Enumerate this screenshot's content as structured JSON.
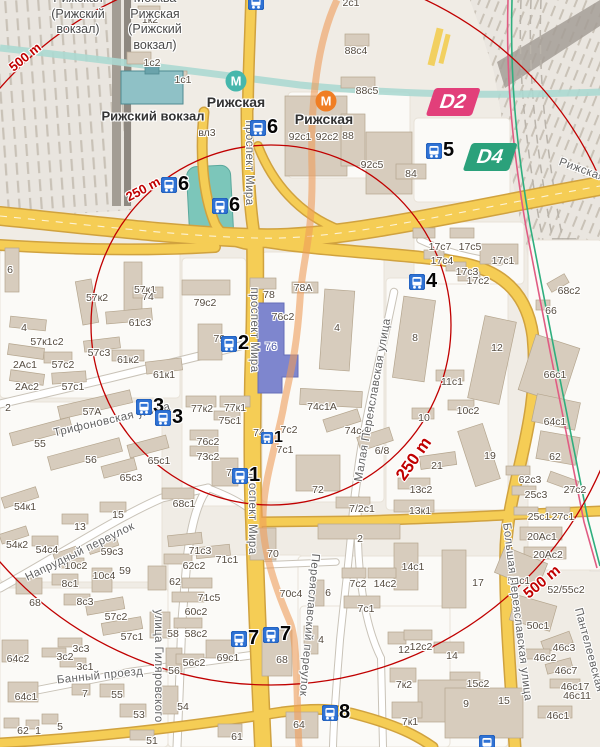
{
  "map": {
    "colors": {
      "land": "#f0ece5",
      "quarter": "#fbfaf7",
      "road_major": "#f5cd55",
      "road_major_casing": "#d0a23f",
      "building": "#d7ccbd",
      "building_stroke": "#b5a68f",
      "water": "#7cc6ba",
      "river": "#acd9d2",
      "rail_area": "#e9e5df",
      "radius_circle": "#c00000",
      "metro_line_overlay": "#ee9d5a",
      "rail_line_green": "#2fae7e",
      "rail_line_pink": "#e05c83",
      "marker_blue": "#2f72d4",
      "highlight_building": "#7e86ce",
      "station_building": "#8fc1c6"
    },
    "circles": {
      "cx": 271,
      "cy": 325,
      "r250": 180,
      "r500": 360
    },
    "radius_labels": [
      {
        "t": "500 m",
        "x": 25,
        "y": 57,
        "r": -39,
        "s": 13
      },
      {
        "t": "250 m",
        "x": 143,
        "y": 189,
        "r": -28,
        "s": 13
      },
      {
        "t": "250 m",
        "x": 414,
        "y": 459,
        "r": -55,
        "s": 17
      },
      {
        "t": "500 m",
        "x": 542,
        "y": 582,
        "r": -40,
        "s": 15
      }
    ],
    "poi_labels": [
      {
        "t": "Рижский вокзал",
        "x": 153,
        "y": 116,
        "s": 13
      },
      {
        "t": "Рижская",
        "x": 236,
        "y": 102,
        "s": 14
      },
      {
        "t": "Рижская",
        "x": 324,
        "y": 119,
        "s": 14
      }
    ],
    "platform_labels": [
      {
        "x": 78,
        "y": -9,
        "lines": [
          "Рижская",
          "(Рижский",
          "вокзал)"
        ]
      },
      {
        "x": 155,
        "y": -9,
        "lines": [
          "Москва",
          "Рижская",
          "(Рижский",
          "вокзал)"
        ]
      }
    ],
    "street_labels": [
      {
        "t": "проспект Мира",
        "x": 249,
        "y": 163,
        "r": 90
      },
      {
        "t": "проспект Мира",
        "x": 254,
        "y": 330,
        "r": 90
      },
      {
        "t": "проспект Мира",
        "x": 252,
        "y": 512,
        "r": 90
      },
      {
        "t": "Трифоновская улица",
        "x": 112,
        "y": 420,
        "r": -13
      },
      {
        "t": "Напрудный переулок",
        "x": 80,
        "y": 552,
        "r": -26
      },
      {
        "t": "Банный проезд",
        "x": 100,
        "y": 676,
        "r": -6
      },
      {
        "t": "улица Гиляровского",
        "x": 158,
        "y": 666,
        "r": 90
      },
      {
        "t": "Малая Переяславская улица",
        "x": 373,
        "y": 400,
        "r": -80
      },
      {
        "t": "Большая Переяславская улица",
        "x": 517,
        "y": 612,
        "r": 83
      },
      {
        "t": "Переяславский переулок",
        "x": 309,
        "y": 625,
        "r": 95
      },
      {
        "t": "Пантелеевская",
        "x": 589,
        "y": 650,
        "r": 75
      },
      {
        "t": "Рижская",
        "x": 582,
        "y": 170,
        "r": 20
      }
    ],
    "building_labels": [
      {
        "t": "1к2",
        "x": 150,
        "y": 20
      },
      {
        "t": "1с2",
        "x": 152,
        "y": 63
      },
      {
        "t": "1с1",
        "x": 183,
        "y": 80
      },
      {
        "t": "вл3",
        "x": 207,
        "y": 133
      },
      {
        "t": "92с1",
        "x": 300,
        "y": 137
      },
      {
        "t": "92с2",
        "x": 327,
        "y": 137
      },
      {
        "t": "88",
        "x": 348,
        "y": 136
      },
      {
        "t": "88с4",
        "x": 356,
        "y": 51
      },
      {
        "t": "88с5",
        "x": 367,
        "y": 91
      },
      {
        "t": "92с5",
        "x": 372,
        "y": 165
      },
      {
        "t": "84",
        "x": 411,
        "y": 174
      },
      {
        "t": "2с1",
        "x": 351,
        "y": 3
      },
      {
        "t": "6",
        "x": 10,
        "y": 270
      },
      {
        "t": "57к1",
        "x": 145,
        "y": 290
      },
      {
        "t": "57к2",
        "x": 97,
        "y": 298
      },
      {
        "t": "74",
        "x": 148,
        "y": 297
      },
      {
        "t": "79с2",
        "x": 205,
        "y": 303
      },
      {
        "t": "78",
        "x": 269,
        "y": 295
      },
      {
        "t": "78А",
        "x": 303,
        "y": 288
      },
      {
        "t": "76с2",
        "x": 283,
        "y": 317
      },
      {
        "t": "61с3",
        "x": 140,
        "y": 323
      },
      {
        "t": "4",
        "x": 24,
        "y": 328
      },
      {
        "t": "57к1с2",
        "x": 47,
        "y": 342
      },
      {
        "t": "57с3",
        "x": 99,
        "y": 353
      },
      {
        "t": "61к2",
        "x": 128,
        "y": 360
      },
      {
        "t": "2Ас1",
        "x": 25,
        "y": 365
      },
      {
        "t": "57с2",
        "x": 63,
        "y": 365
      },
      {
        "t": "61к1",
        "x": 164,
        "y": 375
      },
      {
        "t": "2Ас2",
        "x": 27,
        "y": 387
      },
      {
        "t": "57с1",
        "x": 73,
        "y": 387
      },
      {
        "t": "57А",
        "x": 92,
        "y": 412
      },
      {
        "t": "2",
        "x": 8,
        "y": 408
      },
      {
        "t": "79с",
        "x": 222,
        "y": 339
      },
      {
        "t": "76",
        "x": 271,
        "y": 347,
        "c": "#4d58a9",
        "s": 11
      },
      {
        "t": "77к2",
        "x": 202,
        "y": 409
      },
      {
        "t": "77к1",
        "x": 235,
        "y": 408
      },
      {
        "t": "75с1",
        "x": 230,
        "y": 421
      },
      {
        "t": "76с2",
        "x": 208,
        "y": 442
      },
      {
        "t": "73с2",
        "x": 208,
        "y": 457
      },
      {
        "t": "73",
        "x": 232,
        "y": 473
      },
      {
        "t": "74",
        "x": 259,
        "y": 433
      },
      {
        "t": "7с2",
        "x": 289,
        "y": 430
      },
      {
        "t": "7с1",
        "x": 285,
        "y": 450
      },
      {
        "t": "74с1А",
        "x": 322,
        "y": 407
      },
      {
        "t": "74с4",
        "x": 356,
        "y": 431
      },
      {
        "t": "6/8",
        "x": 382,
        "y": 451
      },
      {
        "t": "72",
        "x": 318,
        "y": 490
      },
      {
        "t": "7/2с1",
        "x": 362,
        "y": 509
      },
      {
        "t": "17с7",
        "x": 440,
        "y": 247
      },
      {
        "t": "17с5",
        "x": 470,
        "y": 247
      },
      {
        "t": "17с4",
        "x": 442,
        "y": 261
      },
      {
        "t": "17с1",
        "x": 503,
        "y": 261
      },
      {
        "t": "17с3",
        "x": 467,
        "y": 272
      },
      {
        "t": "17с2",
        "x": 478,
        "y": 281
      },
      {
        "t": "68с2",
        "x": 569,
        "y": 291
      },
      {
        "t": "66",
        "x": 551,
        "y": 311
      },
      {
        "t": "4",
        "x": 337,
        "y": 328
      },
      {
        "t": "8",
        "x": 415,
        "y": 338
      },
      {
        "t": "12",
        "x": 497,
        "y": 348
      },
      {
        "t": "66с1",
        "x": 555,
        "y": 375
      },
      {
        "t": "11с1",
        "x": 452,
        "y": 382
      },
      {
        "t": "10с2",
        "x": 468,
        "y": 411
      },
      {
        "t": "10",
        "x": 424,
        "y": 418
      },
      {
        "t": "64с1",
        "x": 555,
        "y": 422
      },
      {
        "t": "19",
        "x": 490,
        "y": 456
      },
      {
        "t": "62",
        "x": 555,
        "y": 457
      },
      {
        "t": "21",
        "x": 437,
        "y": 466
      },
      {
        "t": "13с2",
        "x": 421,
        "y": 490
      },
      {
        "t": "62с3",
        "x": 530,
        "y": 480
      },
      {
        "t": "25с3",
        "x": 536,
        "y": 495
      },
      {
        "t": "27с2",
        "x": 575,
        "y": 490
      },
      {
        "t": "13к1",
        "x": 420,
        "y": 511
      },
      {
        "t": "25с1",
        "x": 539,
        "y": 517
      },
      {
        "t": "27с1",
        "x": 563,
        "y": 517
      },
      {
        "t": "2",
        "x": 360,
        "y": 539
      },
      {
        "t": "20Ас1",
        "x": 542,
        "y": 537
      },
      {
        "t": "20Ас2",
        "x": 548,
        "y": 555
      },
      {
        "t": "14с1",
        "x": 413,
        "y": 567
      },
      {
        "t": "55",
        "x": 40,
        "y": 444
      },
      {
        "t": "56",
        "x": 91,
        "y": 460
      },
      {
        "t": "65с1",
        "x": 159,
        "y": 461
      },
      {
        "t": "65с3",
        "x": 131,
        "y": 478
      },
      {
        "t": "68с1",
        "x": 184,
        "y": 504
      },
      {
        "t": "15",
        "x": 118,
        "y": 515
      },
      {
        "t": "13",
        "x": 80,
        "y": 527
      },
      {
        "t": "54к1",
        "x": 25,
        "y": 507
      },
      {
        "t": "54к2",
        "x": 17,
        "y": 545
      },
      {
        "t": "54с4",
        "x": 47,
        "y": 550
      },
      {
        "t": "59с3",
        "x": 112,
        "y": 552
      },
      {
        "t": "10с2",
        "x": 76,
        "y": 566
      },
      {
        "t": "10с4",
        "x": 104,
        "y": 576
      },
      {
        "t": "59",
        "x": 125,
        "y": 571
      },
      {
        "t": "70",
        "x": 273,
        "y": 554
      },
      {
        "t": "71с3",
        "x": 200,
        "y": 551
      },
      {
        "t": "71с1",
        "x": 227,
        "y": 560
      },
      {
        "t": "62с2",
        "x": 194,
        "y": 566
      },
      {
        "t": "62",
        "x": 175,
        "y": 582
      },
      {
        "t": "71с5",
        "x": 209,
        "y": 598
      },
      {
        "t": "60с2",
        "x": 196,
        "y": 612
      },
      {
        "t": "70с4",
        "x": 291,
        "y": 594
      },
      {
        "t": "58",
        "x": 173,
        "y": 634
      },
      {
        "t": "58с2",
        "x": 196,
        "y": 634
      },
      {
        "t": "56с2",
        "x": 194,
        "y": 663
      },
      {
        "t": "56",
        "x": 174,
        "y": 671
      },
      {
        "t": "69с1",
        "x": 228,
        "y": 658
      },
      {
        "t": "68",
        "x": 282,
        "y": 660
      },
      {
        "t": "54",
        "x": 183,
        "y": 707
      },
      {
        "t": "61",
        "x": 237,
        "y": 737
      },
      {
        "t": "68",
        "x": 35,
        "y": 603
      },
      {
        "t": "8с1",
        "x": 70,
        "y": 584
      },
      {
        "t": "8с3",
        "x": 85,
        "y": 602
      },
      {
        "t": "57с2",
        "x": 116,
        "y": 617
      },
      {
        "t": "57с1",
        "x": 132,
        "y": 637
      },
      {
        "t": "3с3",
        "x": 81,
        "y": 649
      },
      {
        "t": "3с2",
        "x": 65,
        "y": 657
      },
      {
        "t": "3с1",
        "x": 85,
        "y": 667
      },
      {
        "t": "64с2",
        "x": 18,
        "y": 659
      },
      {
        "t": "64с1",
        "x": 26,
        "y": 697
      },
      {
        "t": "7",
        "x": 85,
        "y": 694
      },
      {
        "t": "55",
        "x": 117,
        "y": 695
      },
      {
        "t": "53",
        "x": 139,
        "y": 715
      },
      {
        "t": "5",
        "x": 60,
        "y": 727
      },
      {
        "t": "1",
        "x": 38,
        "y": 731
      },
      {
        "t": "62",
        "x": 23,
        "y": 731
      },
      {
        "t": "51",
        "x": 152,
        "y": 741
      },
      {
        "t": "64",
        "x": 299,
        "y": 725
      },
      {
        "t": "7с2",
        "x": 358,
        "y": 584
      },
      {
        "t": "14с2",
        "x": 385,
        "y": 584
      },
      {
        "t": "7с1",
        "x": 366,
        "y": 609
      },
      {
        "t": "6",
        "x": 328,
        "y": 593
      },
      {
        "t": "4",
        "x": 321,
        "y": 640
      },
      {
        "t": "17",
        "x": 478,
        "y": 583
      },
      {
        "t": "52с1",
        "x": 519,
        "y": 581
      },
      {
        "t": "52/55с2",
        "x": 566,
        "y": 590
      },
      {
        "t": "50с1",
        "x": 538,
        "y": 626
      },
      {
        "t": "46с3",
        "x": 564,
        "y": 648
      },
      {
        "t": "46с2",
        "x": 545,
        "y": 658
      },
      {
        "t": "46с7",
        "x": 566,
        "y": 671
      },
      {
        "t": "46с17",
        "x": 575,
        "y": 687
      },
      {
        "t": "46с11",
        "x": 577,
        "y": 696
      },
      {
        "t": "46с1",
        "x": 558,
        "y": 716
      },
      {
        "t": "12",
        "x": 404,
        "y": 650
      },
      {
        "t": "12с2",
        "x": 421,
        "y": 647
      },
      {
        "t": "14",
        "x": 452,
        "y": 656
      },
      {
        "t": "15с2",
        "x": 478,
        "y": 684
      },
      {
        "t": "15",
        "x": 504,
        "y": 701
      },
      {
        "t": "9",
        "x": 466,
        "y": 704
      },
      {
        "t": "7к2",
        "x": 404,
        "y": 685
      },
      {
        "t": "7к1",
        "x": 410,
        "y": 722
      }
    ],
    "markers": [
      {
        "n": "6",
        "x": 258,
        "y": 124
      },
      {
        "n": "6",
        "x": 169,
        "y": 181
      },
      {
        "n": "6",
        "x": 220,
        "y": 202
      },
      {
        "n": "5",
        "x": 434,
        "y": 147,
        "icon": "train"
      },
      {
        "n": "4",
        "x": 417,
        "y": 278
      },
      {
        "n": "2",
        "x": 229,
        "y": 340
      },
      {
        "n": "3",
        "x": 144,
        "y": 403
      },
      {
        "n": "3",
        "x": 163,
        "y": 414
      },
      {
        "n": "1",
        "x": 267,
        "y": 435,
        "small": true
      },
      {
        "n": "1",
        "x": 240,
        "y": 472
      },
      {
        "n": "7",
        "x": 239,
        "y": 635
      },
      {
        "n": "7",
        "x": 271,
        "y": 631
      },
      {
        "n": "8",
        "x": 330,
        "y": 709
      },
      {
        "n": "",
        "x": 487,
        "y": 743
      },
      {
        "n": "",
        "x": 256,
        "y": 2
      }
    ],
    "metro_logos": [
      {
        "t": "М",
        "x": 236,
        "y": 81,
        "c": "#46b7ac"
      },
      {
        "t": "М",
        "x": 326,
        "y": 101,
        "c": "#f07e24"
      }
    ],
    "badges": [
      {
        "t": "D2",
        "x": 453,
        "y": 102,
        "c": "#e23f7a"
      },
      {
        "t": "D4",
        "x": 490,
        "y": 157,
        "c": "#2ba17b"
      }
    ]
  }
}
